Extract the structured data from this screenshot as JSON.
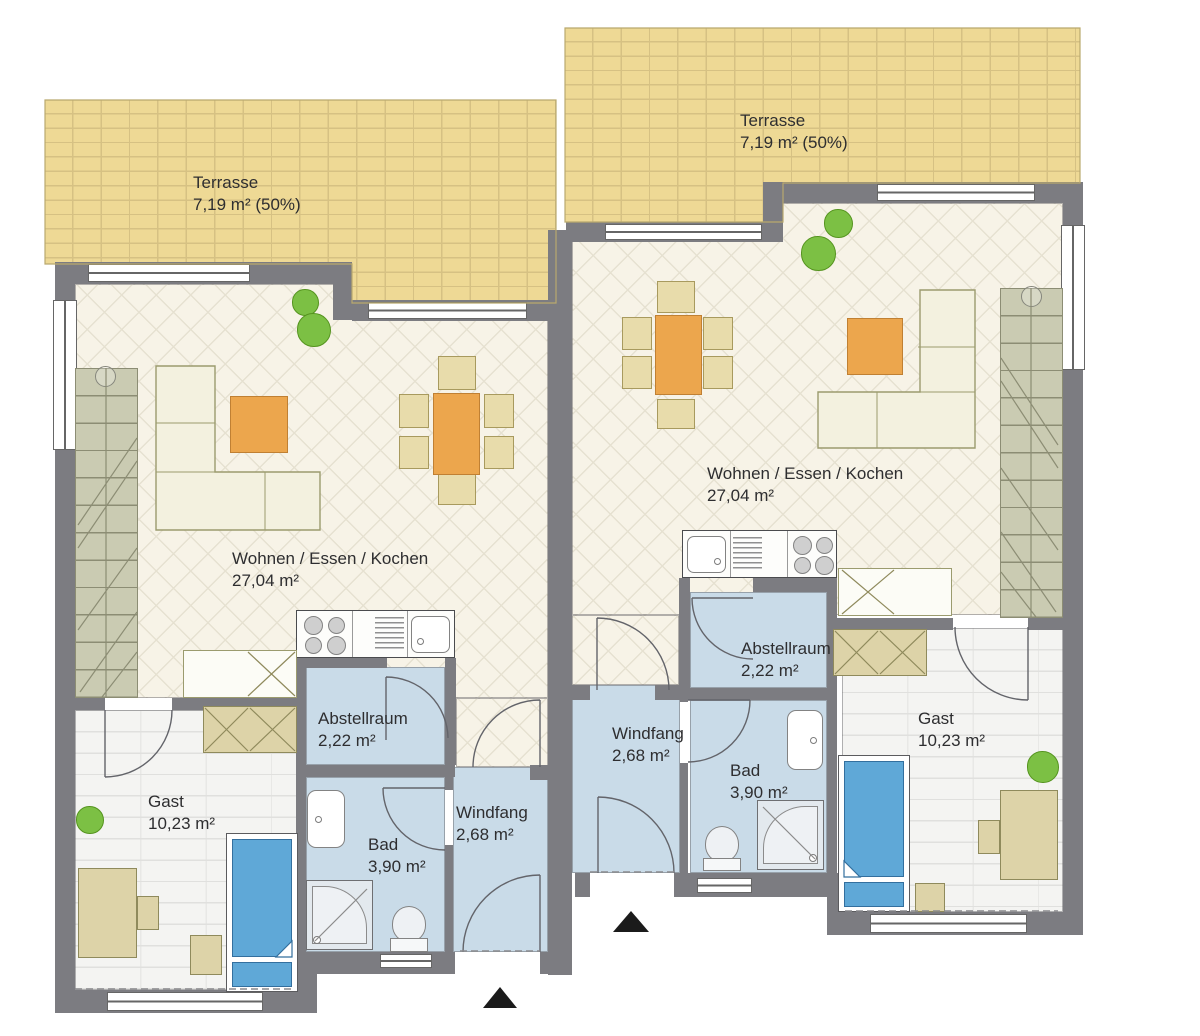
{
  "units": {
    "left": {
      "terrasse": {
        "name": "Terrasse",
        "area": "7,19 m² (50%)"
      },
      "wohnen": {
        "name": "Wohnen / Essen / Kochen",
        "area": "27,04 m²"
      },
      "abstellraum": {
        "name": "Abstellraum",
        "area": "2,22 m²"
      },
      "windfang": {
        "name": "Windfang",
        "area": "2,68 m²"
      },
      "bad": {
        "name": "Bad",
        "area": "3,90 m²"
      },
      "gast": {
        "name": "Gast",
        "area": "10,23 m²"
      }
    },
    "right": {
      "terrasse": {
        "name": "Terrasse",
        "area": "7,19 m² (50%)"
      },
      "wohnen": {
        "name": "Wohnen / Essen / Kochen",
        "area": "27,04 m²"
      },
      "abstellraum": {
        "name": "Abstellraum",
        "area": "2,22 m²"
      },
      "windfang": {
        "name": "Windfang",
        "area": "2,68 m²"
      },
      "bad": {
        "name": "Bad",
        "area": "3,90 m²"
      },
      "gast": {
        "name": "Gast",
        "area": "10,23 m²"
      }
    }
  },
  "colors": {
    "wall": "#7c7c81",
    "terrace": "#eed995",
    "terrace-line": "#d6c183",
    "floor": "#f7f3e7",
    "floor-line": "#e6e1d1",
    "wet": "#c9dbe8",
    "guest-floor": "#f4f4f2",
    "stairs": "#cacbb2",
    "stairs-line": "#8c8d74",
    "furniture": "#f3f1df",
    "furniture-line": "#9b9b6e",
    "accent-orange": "#eca64d",
    "chair-tan": "#e8dcab",
    "wardrobe-tan": "#ddd3a8",
    "bed-blue": "#5fa8d7",
    "tree-green": "#7cc044"
  }
}
